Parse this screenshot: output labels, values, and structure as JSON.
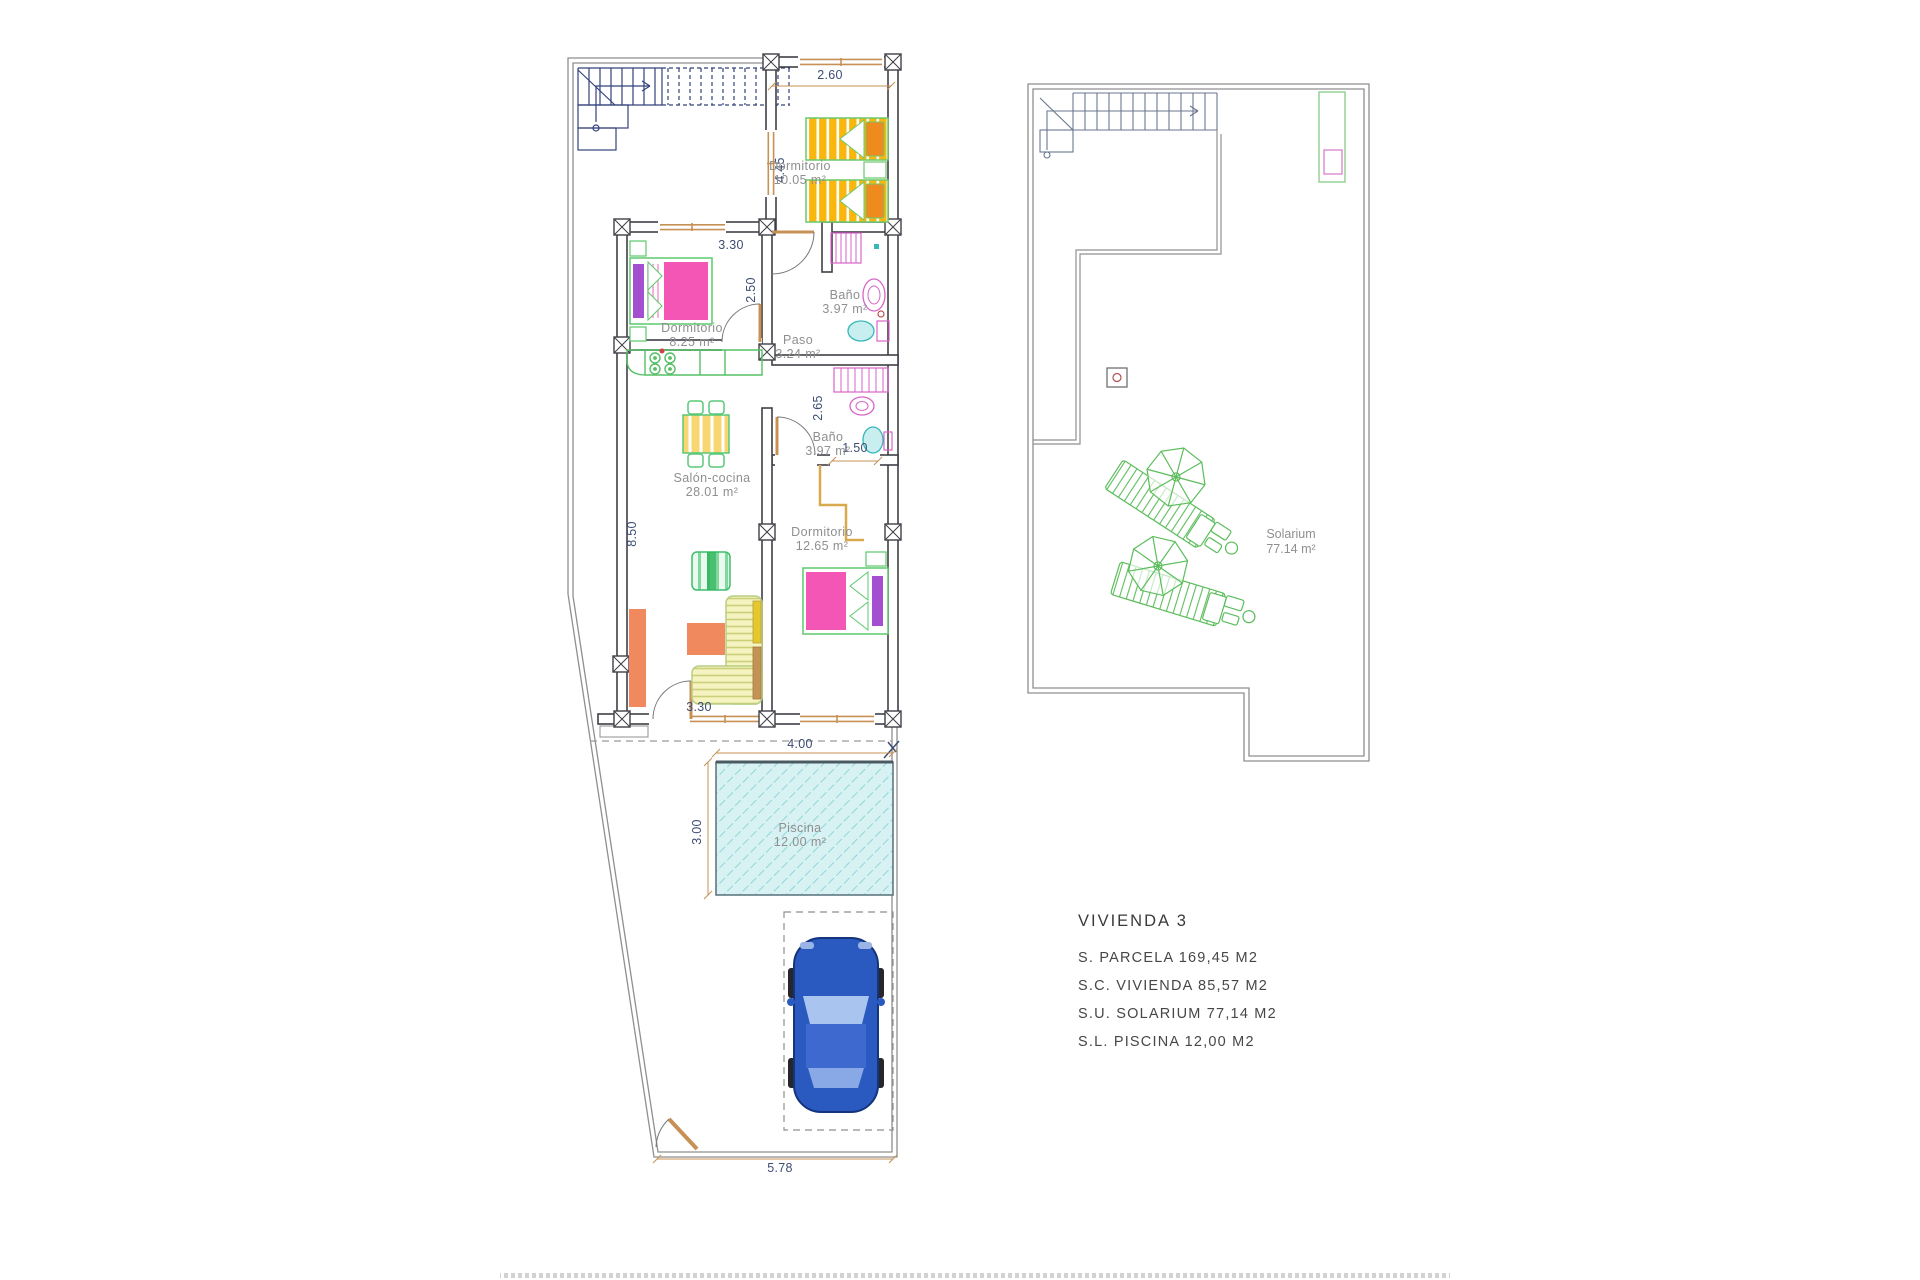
{
  "title_block": {
    "title": "VIVIENDA 3",
    "lines": [
      "S. PARCELA 169,45 M2",
      "S.C. VIVIENDA 85,57 M2",
      "S.U. SOLARIUM 77,14 M2",
      "S.L. PISCINA 12,00 M2"
    ]
  },
  "rooms": {
    "dormitorio_1": {
      "name": "Dormitorio",
      "area": "10.05 m²"
    },
    "dormitorio_2": {
      "name": "Dormitorio",
      "area": "8.25 m²"
    },
    "dormitorio_3": {
      "name": "Dormitorio",
      "area": "12.65 m²"
    },
    "bano_1": {
      "name": "Baño",
      "area": "3.97 m²"
    },
    "bano_2": {
      "name": "Baño",
      "area": "3.97 m²"
    },
    "paso": {
      "name": "Paso",
      "area": "3.24 m²"
    },
    "salon_cocina": {
      "name": "Salón-cocina",
      "area": "28.01 m²"
    },
    "piscina": {
      "name": "Piscina",
      "area": "12.00 m²"
    },
    "solarium": {
      "name": "Solarium",
      "area": "77.14 m²"
    }
  },
  "dimensions": {
    "d_2_60": "2.60",
    "d_4_45": "4.45",
    "d_3_30_top": "3.30",
    "d_2_50": "2.50",
    "d_8_50": "8.50",
    "d_2_65": "2.65",
    "d_1_50": "1.50",
    "d_3_30_bottom": "3.30",
    "d_4_00": "4.00",
    "d_3_00": "3.00",
    "d_5_78": "5.78"
  },
  "colors": {
    "walls": "#3f3f46",
    "boundary": "#8f8f8f",
    "stairs_ground": "#33427c",
    "stairs_roof": "#6a7690",
    "dimension_text": "#3d4d73",
    "room_label": "#8f8f8f",
    "window_frame": "#c79055",
    "pool_water": "#d8f1f3",
    "pool_hatch": "#8ed7da",
    "bed_orange": "#f9b70e",
    "pillow_orange": "#ef8a1e",
    "bed_pink": "#f356b4",
    "bed_purple": "#a44fd0",
    "furniture_green": "#58c878",
    "sofa_cream": "#f5f3c0",
    "rug_salmon": "#f08a5e",
    "car_blue": "#2a59c0",
    "solarium_green": "#5cbd5c",
    "fixture_pink": "#d863c8",
    "fixture_teal": "#38b8b8"
  }
}
